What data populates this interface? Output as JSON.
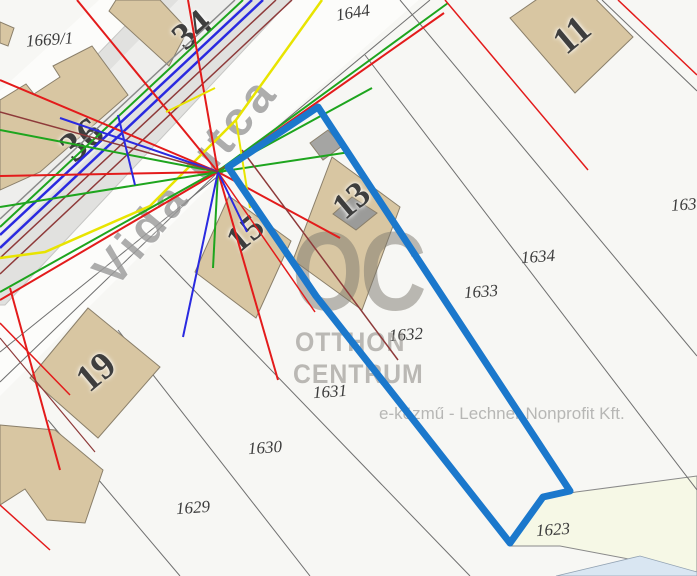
{
  "map": {
    "street_name": "Vida utca",
    "attribution": "e-közmű - Lechner Nonprofit Kft.",
    "watermark": {
      "logo": "OC",
      "line1": "OTTHON",
      "line2": "CENTRUM"
    },
    "highlighted_parcel": "1632",
    "parcel_labels": [
      {
        "text": "1669/1"
      },
      {
        "text": "1644"
      },
      {
        "text": "163"
      },
      {
        "text": "1634"
      },
      {
        "text": "1633"
      },
      {
        "text": "1632"
      },
      {
        "text": "1631"
      },
      {
        "text": "1630"
      },
      {
        "text": "1629"
      },
      {
        "text": "1623"
      }
    ],
    "house_numbers": [
      {
        "text": "36"
      },
      {
        "text": "34"
      },
      {
        "text": "11"
      },
      {
        "text": "15"
      },
      {
        "text": "13"
      },
      {
        "text": "19"
      }
    ],
    "colors": {
      "highlight": "#1b78cc",
      "building": "#d8c6a2",
      "pavement": "#e1e1df",
      "road_parcel": "#f6f8e6",
      "red": "#e31b1b",
      "green": "#1ea51e",
      "blue": "#2a2ae0",
      "yellow": "#e8e400",
      "maroon": "#8e3a3a",
      "parcel_line": "#6f6f6f"
    }
  }
}
